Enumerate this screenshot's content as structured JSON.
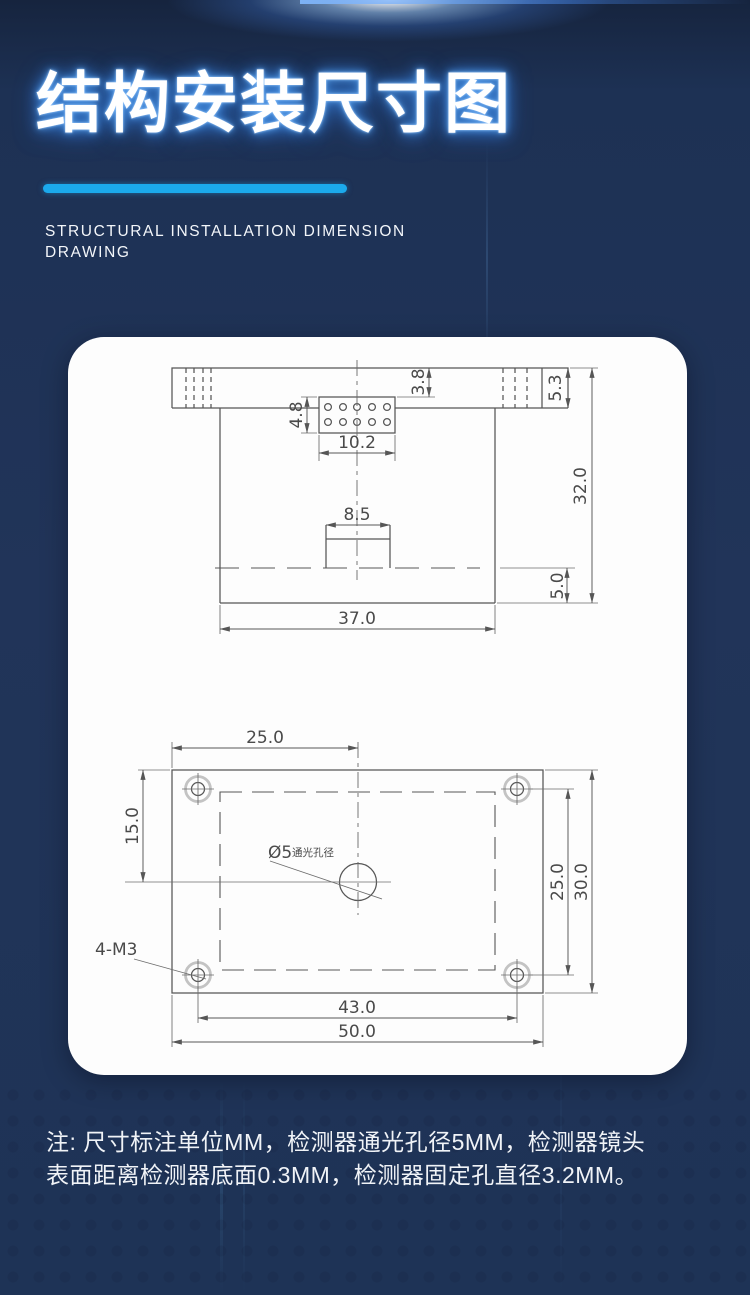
{
  "header": {
    "title": "结构安装尺寸图",
    "subtitle_line1": "STRUCTURAL INSTALLATION DIMENSION",
    "subtitle_line2": "DRAWING"
  },
  "colors": {
    "background": "#1e3356",
    "accent_bar": "#1ba9ec",
    "card": "#fdfdfd",
    "title_glow": "#3a86dd"
  },
  "side_view": {
    "dim_step_height": "3.8",
    "dim_flange_height": "5.3",
    "dim_connector_height": "4.8",
    "dim_connector_width": "10.2",
    "dim_lens_width": "8.5",
    "dim_total_height": "32.0",
    "dim_base_height": "5.0",
    "dim_body_width": "37.0"
  },
  "top_view": {
    "dim_center_offset_x": "25.0",
    "dim_center_offset_y": "15.0",
    "dim_hole_pitch_y": "25.0",
    "dim_plate_height": "30.0",
    "dim_hole_pitch_x": "43.0",
    "dim_plate_width": "50.0",
    "label_aperture_symbol": "Ø5",
    "label_aperture_text": "通光孔径",
    "label_screw_spec": "4-M3"
  },
  "note": {
    "line1": "注: 尺寸标注单位MM，检测器通光孔径5MM，检测器镜头",
    "line2": "表面距离检测器底面0.3MM，检测器固定孔直径3.2MM。"
  }
}
